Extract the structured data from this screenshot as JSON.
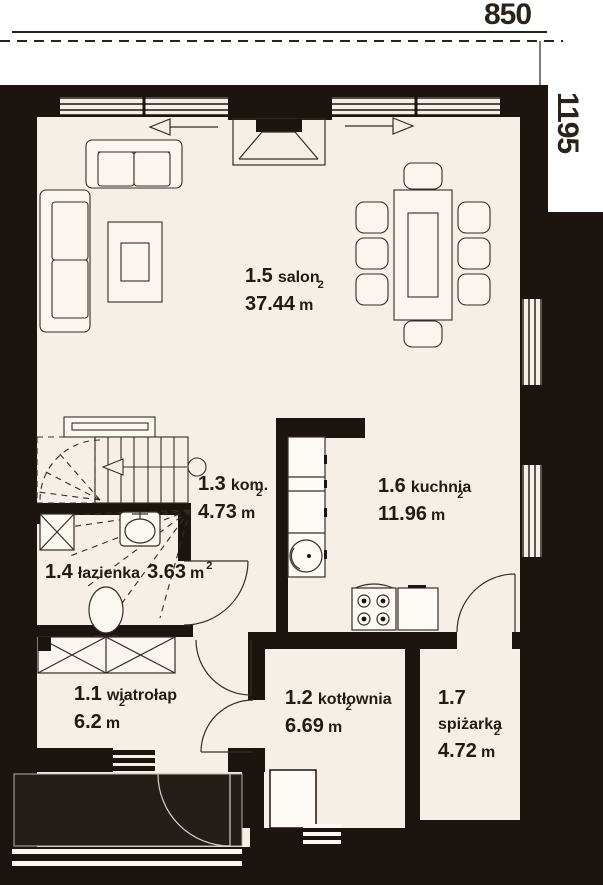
{
  "dimensions": {
    "width_label": "850",
    "height_label": "1195"
  },
  "rooms": {
    "salon": {
      "number": "1.5",
      "name": "salon",
      "area": "37.44",
      "unit": "m",
      "sup": "2"
    },
    "kom": {
      "number": "1.3",
      "name": "kom.",
      "area": "4.73",
      "unit": "m",
      "sup": "2"
    },
    "kuchnia": {
      "number": "1.6",
      "name": "kuchnia",
      "area": "11.96",
      "unit": "m",
      "sup": "2"
    },
    "lazienka": {
      "number": "1.4",
      "name": "łazienka",
      "area": "3.63",
      "unit": "m",
      "sup": "2"
    },
    "wiatrolap": {
      "number": "1.1",
      "name": "wiatrołap",
      "area": "6.2",
      "unit": "m",
      "sup": "2"
    },
    "kotlownia": {
      "number": "1.2",
      "name": "kotłownia",
      "area": "6.69",
      "unit": "m",
      "sup": "2"
    },
    "spizarka": {
      "number": "1.7",
      "name": "spiżarka",
      "area": "4.72",
      "unit": "m",
      "sup": "2"
    }
  },
  "colors": {
    "wall": "#1c150f",
    "floor": "#f6efe8",
    "outline": "#352d25",
    "background": "#ffffff",
    "porch": "#251e18"
  }
}
